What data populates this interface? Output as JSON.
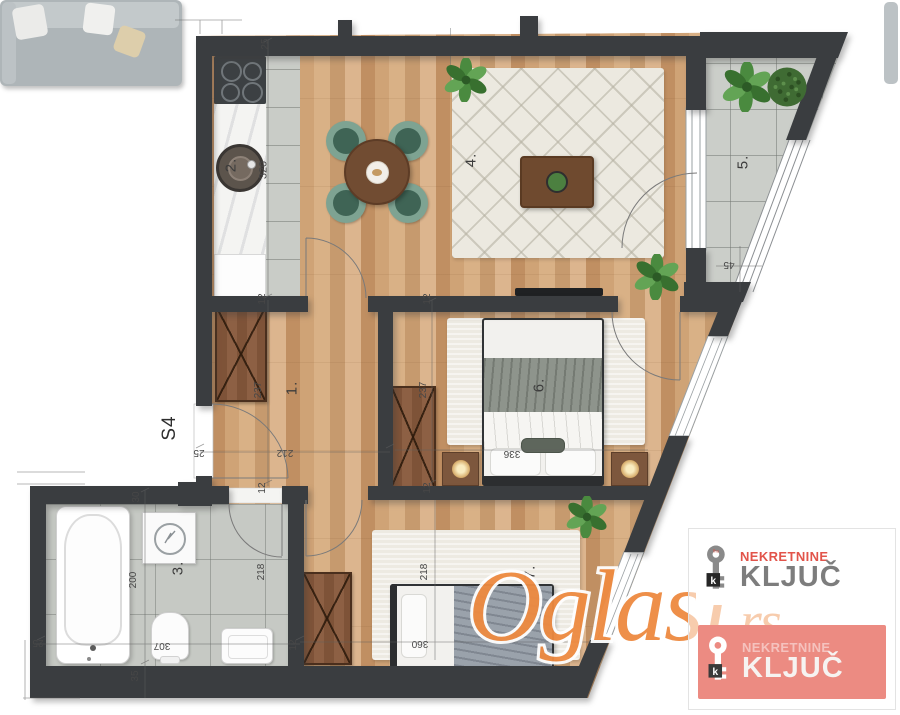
{
  "plan": {
    "unit_label": "S4",
    "rooms": {
      "hall": "1.",
      "kitchen": "2.",
      "bathroom": "3.",
      "living": "4.",
      "terrace": "5.",
      "bedroom_main": "6.",
      "bedroom_second": "7."
    },
    "dims": {
      "wall_thickness": "12",
      "kitchen_top": "25",
      "kitchen_depth": "320",
      "hall_depth": "237",
      "hall_width": "212",
      "entry_width": "25",
      "bedroom_main_depth": "237",
      "bedroom_main_width": "336",
      "terrace_width": "45",
      "bath_top": "30",
      "bath_depth": "200",
      "bath_inner": "218",
      "bath_width": "307",
      "bath_left": "25",
      "bath_bottom": "35",
      "bedroom_second_depth": "218",
      "bedroom_second_width": "360"
    }
  },
  "watermark": {
    "name": "Oglasi",
    "tld": ".rs"
  },
  "logos": {
    "key_glyph": "k",
    "key_badge": "fha",
    "primary": {
      "line1": "NEKRETNINE",
      "line2": "KLJUČ"
    },
    "secondary": {
      "line1": "NEKRETNINE",
      "line2": "KLJUČ"
    }
  },
  "colors": {
    "wall": "#3a3d40",
    "wood": "#d2a87c",
    "tile": "#c9ccc7",
    "chair_green": "#3f6455",
    "watermark_orange": "#ee8a40",
    "brand_red": "#e2544a",
    "brand_gray": "#7d7d7d"
  }
}
